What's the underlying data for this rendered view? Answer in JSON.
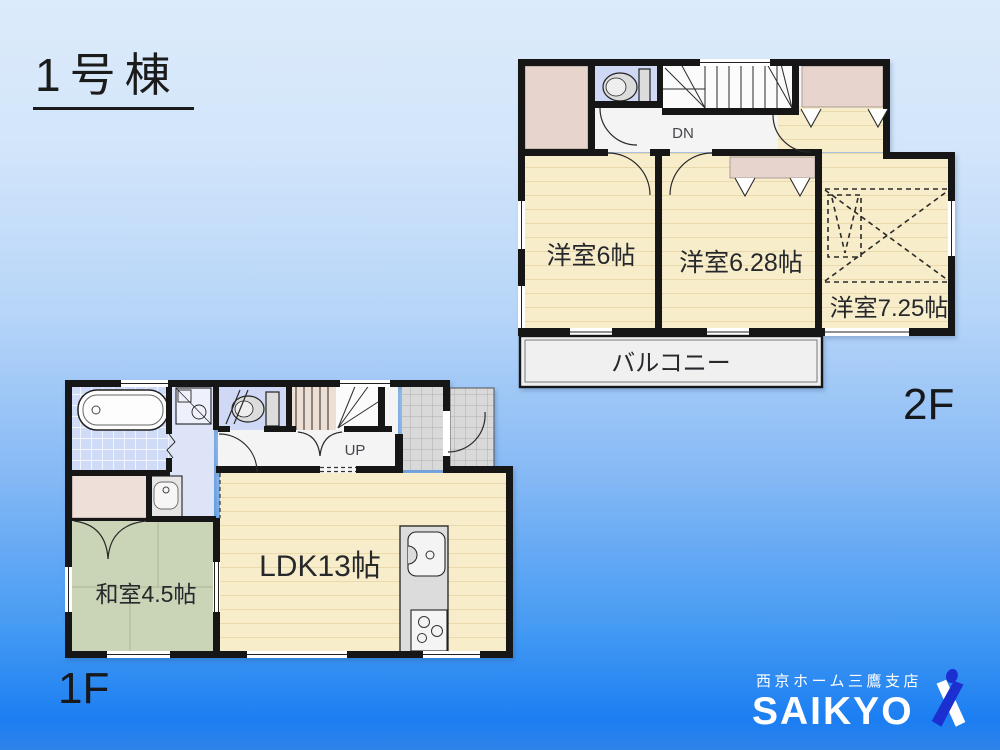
{
  "title": "1号棟",
  "colors": {
    "wall": "#161616",
    "wood_floor": "#f8edcb",
    "wood_line": "#e9d9ab",
    "tatami": "#cad4b6",
    "closet": "#e7d4cc",
    "tile_blue": "#cfdbf7",
    "entry_tile": "#d9d9d9",
    "bg_top": "#dcebfb",
    "bg_bottom": "#1b7ef2",
    "logo_blue": "#1c2fd0"
  },
  "floor2": {
    "label": "2F",
    "rooms": {
      "west": {
        "label": "洋室6帖"
      },
      "middle": {
        "label": "洋室6.28帖"
      },
      "east": {
        "label": "洋室7.25帖"
      },
      "balcony": {
        "label": "バルコニー"
      }
    },
    "stairs": {
      "label": "DN"
    }
  },
  "floor1": {
    "label": "1F",
    "rooms": {
      "washitsu": {
        "label": "和室4.5帖"
      },
      "ldk": {
        "label": "LDK13帖"
      }
    },
    "stairs": {
      "label": "UP"
    }
  },
  "logo": {
    "branch": "西京ホーム三鷹支店",
    "brand": "SAIKYO"
  }
}
